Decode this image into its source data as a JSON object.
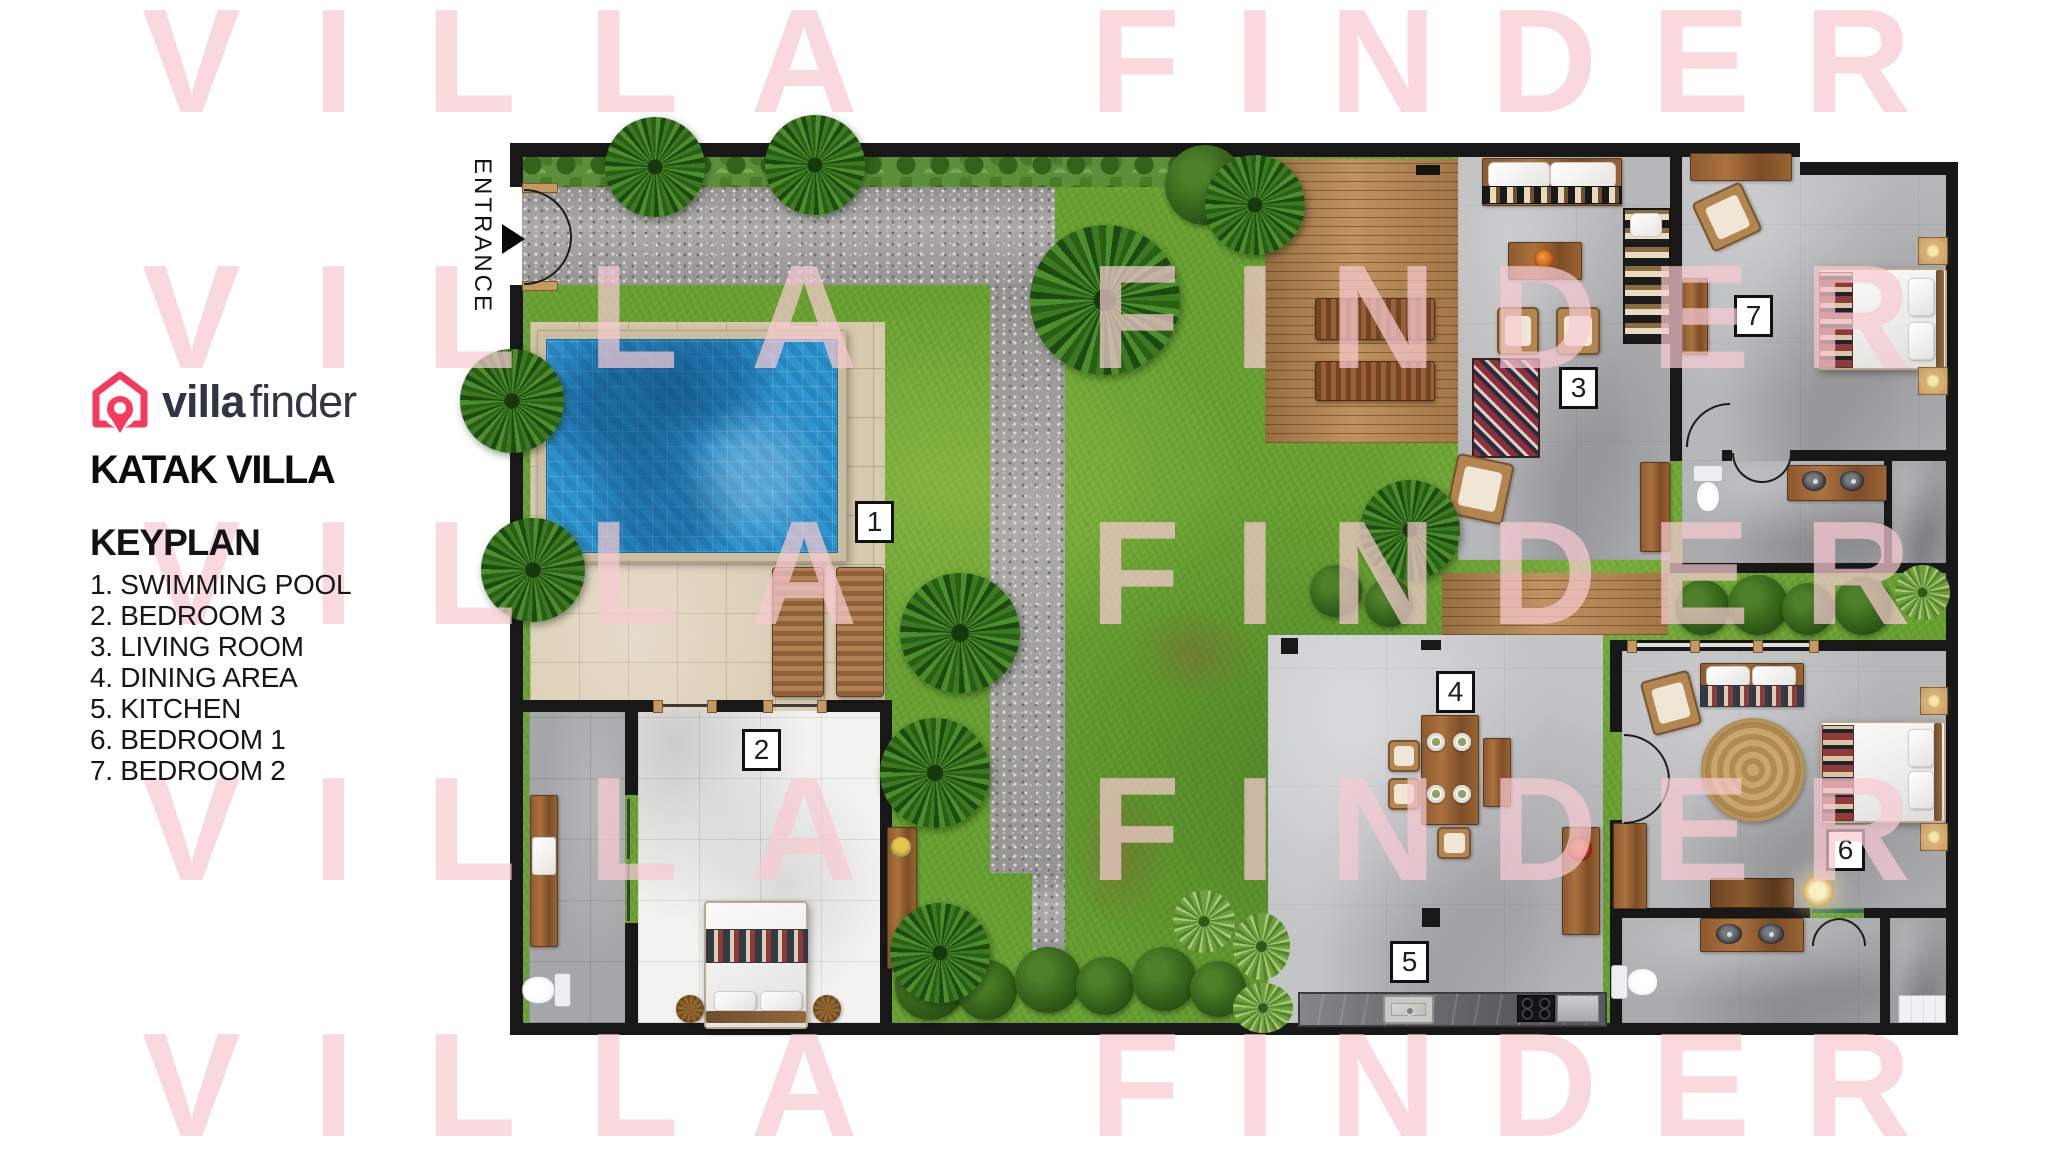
{
  "brand": {
    "logo_bold": "villa",
    "logo_light": "finder",
    "accent_color": "#f5395f",
    "wordmark_color": "#303643"
  },
  "villa_title": "KATAK VILLA",
  "keyplan": {
    "heading": "KEYPLAN",
    "items": [
      "1. SWIMMING POOL",
      "2. BEDROOM 3",
      "3. LIVING ROOM",
      "4. DINING AREA",
      "5. KITCHEN",
      "6. BEDROOM 1",
      "7. BEDROOM 2"
    ]
  },
  "plan": {
    "entrance_label": "ENTRANCE",
    "room_markers": [
      {
        "number": "1",
        "area": "swimming pool"
      },
      {
        "number": "2",
        "area": "bedroom 3"
      },
      {
        "number": "3",
        "area": "living room"
      },
      {
        "number": "4",
        "area": "dining area"
      },
      {
        "number": "5",
        "area": "kitchen"
      },
      {
        "number": "6",
        "area": "bedroom 1"
      },
      {
        "number": "7",
        "area": "bedroom 2"
      }
    ]
  },
  "watermark": {
    "word1": "VILLA",
    "word2": "FINDER",
    "color": "#fadfe1"
  },
  "colors": {
    "pool_water": "#2d94cf",
    "grass": "#69a230",
    "wall": "#181818"
  }
}
